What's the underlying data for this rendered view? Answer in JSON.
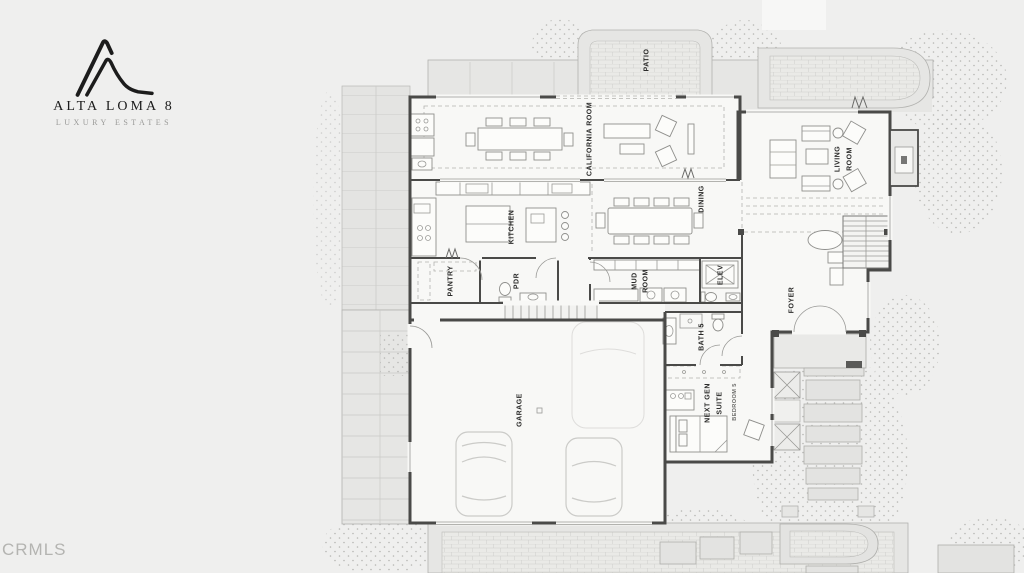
{
  "branding": {
    "title": "ALTA LOMA 8",
    "subtitle": "LUXURY ESTATES"
  },
  "watermark": "CRMLS",
  "floorplan": {
    "labels": {
      "patio": "PATIO",
      "california_room": "CALIFORNIA ROOM",
      "living_l1": "LIVING",
      "living_l2": "ROOM",
      "kitchen": "KITCHEN",
      "dining": "DINING",
      "pantry": "PANTRY",
      "powder": "PDR",
      "mud_l1": "MUD",
      "mud_l2": "ROOM",
      "elevator": "ELEV",
      "foyer": "FOYER",
      "bath5": "BATH 5",
      "nextgen_l1": "NEXT GEN",
      "nextgen_l2": "SUITE",
      "bedroom5": "BEDROOM 5",
      "garage": "GARAGE"
    },
    "colors": {
      "background": "#efefee",
      "hardscape": "#e6e6e4",
      "room": "#f8f8f6",
      "wall": "#4a4a48",
      "furniture": "#8f8f8c",
      "brand": "#1c1c1c",
      "watermark": "#b4b4b1"
    }
  }
}
